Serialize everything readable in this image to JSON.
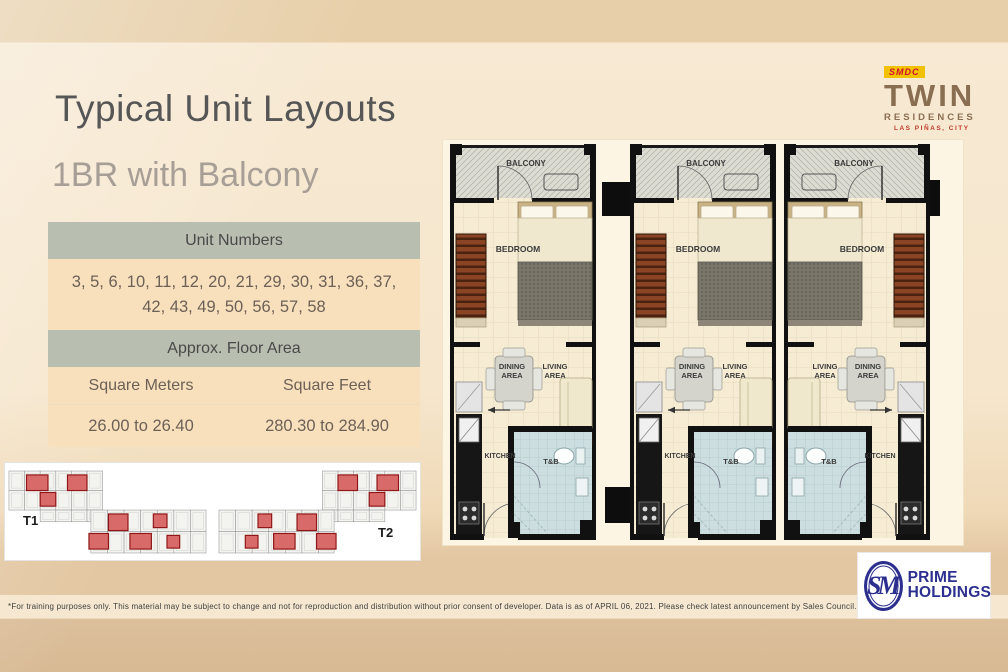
{
  "page": {
    "title": "Typical Unit Layouts",
    "subtitle": "1BR with Balcony"
  },
  "brand": {
    "smdc": "SMDC",
    "name": "TWIN",
    "sub": "RESIDENCES",
    "location": "LAS PIÑAS, CITY"
  },
  "info_table": {
    "unit_numbers_header": "Unit Numbers",
    "unit_numbers": "3, 5, 6, 10, 11, 12, 20, 21, 29, 30, 31, 36, 37, 42, 43, 49, 50, 56, 57, 58",
    "floor_area_header": "Approx. Floor Area",
    "col_sqm": "Square Meters",
    "col_sqft": "Square Feet",
    "val_sqm": "26.00 to 26.40",
    "val_sqft": "280.30 to 284.90"
  },
  "floor_plans": {
    "labels": {
      "balcony": "BALCONY",
      "bedroom": "BEDROOM",
      "dining": "DINING",
      "living": "LIVING",
      "area": "AREA",
      "kitchen": "KITCHEN",
      "tb": "T&B"
    },
    "units": [
      {
        "name": "unit-a",
        "mirrored": false
      },
      {
        "name": "unit-b",
        "mirrored": false
      },
      {
        "name": "unit-c",
        "mirrored": true
      }
    ]
  },
  "floorplates": {
    "t1_label": "T1",
    "t2_label": "T2",
    "t1_highlights": [
      [
        20,
        8,
        22,
        16
      ],
      [
        62,
        8,
        20,
        16
      ],
      [
        34,
        26,
        16,
        14
      ],
      [
        104,
        48,
        20,
        17
      ],
      [
        150,
        48,
        14,
        14
      ],
      [
        84,
        68,
        20,
        16
      ],
      [
        126,
        68,
        22,
        16
      ],
      [
        164,
        70,
        13,
        13
      ]
    ],
    "t2_mirrored_from_t1": true
  },
  "footer": {
    "disclaimer": "*For training purposes only.  This material may be subject to change and not for reproduction and distribution without prior consent of developer.  Data is as of APRIL 06, 2021.  Please check latest announcement by Sales Council.",
    "sm": "SM",
    "prime": "PRIME",
    "holdings": "HOLDINGS"
  },
  "colors": {
    "table_header_bg": "#b8bfb1",
    "table_row_bg": "#f9e0bd",
    "highlight_unit": "#d96a6a",
    "brand_brown": "#8a6e52",
    "badge_yellow": "#f2c200",
    "badge_red": "#d01030",
    "sm_blue": "#2d2f8f",
    "tb_blue": "#ccdedf"
  }
}
